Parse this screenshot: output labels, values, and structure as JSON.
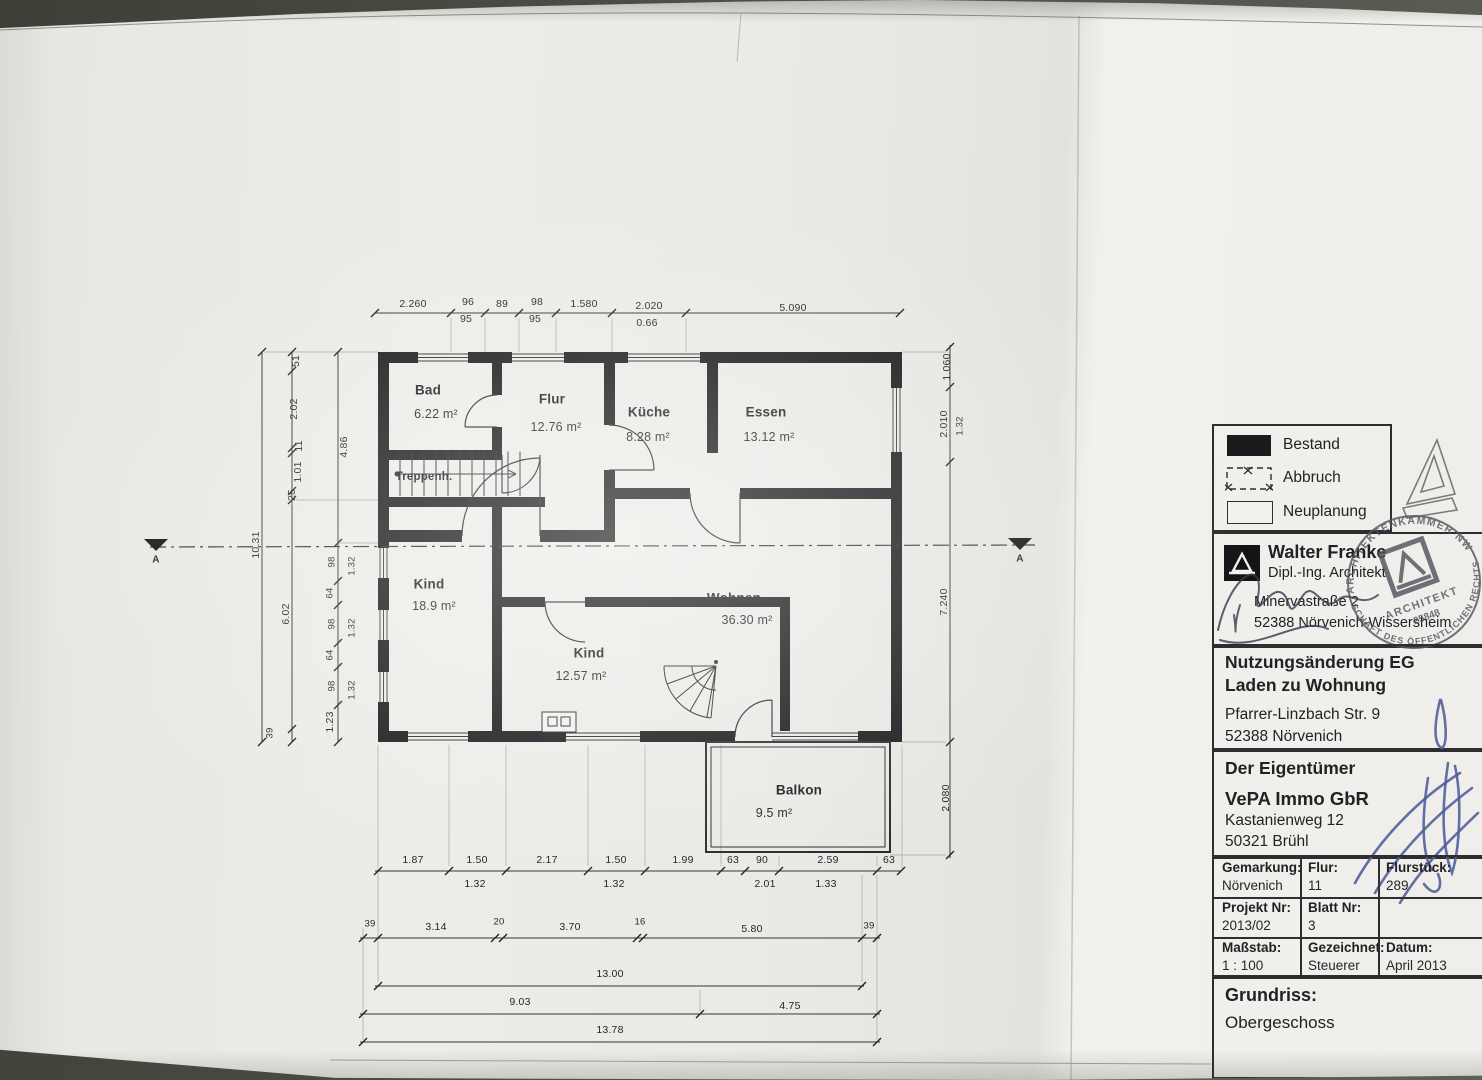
{
  "colors": {
    "background": "#4a4e44",
    "paper": "#edece8",
    "ink": "#222226",
    "wall": "#1b1b1d",
    "signature_blue": "#4d5d9a",
    "stamp_ink": "#54545f"
  },
  "rooms": {
    "bad": {
      "name": "Bad",
      "area": "6.22 m²"
    },
    "flur": {
      "name": "Flur",
      "area": "12.76 m²"
    },
    "kueche": {
      "name": "Küche",
      "area": "8.28 m²"
    },
    "essen": {
      "name": "Essen",
      "area": "13.12 m²"
    },
    "treppenhaus": {
      "name": "Treppenh."
    },
    "kind1": {
      "name": "Kind",
      "area": "18.9 m²"
    },
    "kind2": {
      "name": "Kind",
      "area": "12.57 m²"
    },
    "wohnen": {
      "name": "Wohnen",
      "area": "36.30 m²"
    },
    "balkon": {
      "name": "Balkon",
      "area": "9.5 m²"
    }
  },
  "dims": {
    "top": [
      "2.260",
      "96",
      "95",
      "89",
      "98",
      "95",
      "1.580",
      "2.020",
      "0.66",
      "5.090"
    ],
    "left": [
      "10.31",
      "51",
      "2.02",
      "11",
      "1.01",
      "25",
      "6.02",
      "1.23",
      "39",
      "4.86",
      "98",
      "1.32",
      "64",
      "98",
      "1.32",
      "64",
      "98",
      "1.32"
    ],
    "right": [
      "1.060",
      "2.010",
      "1.32",
      "7.240",
      "2.080"
    ],
    "bottom1": [
      "1.87",
      "1.50",
      "1.32",
      "2.17",
      "1.50",
      "1.32",
      "1.99",
      "63",
      "90",
      "2.01",
      "2.59",
      "1.33",
      "63"
    ],
    "bottom2": [
      "39",
      "3.14",
      "20",
      "3.70",
      "16",
      "5.80",
      "39"
    ],
    "bottom3": [
      "13.00"
    ],
    "bottom4": [
      "9.03",
      "4.75"
    ],
    "bottom5": [
      "13.78"
    ]
  },
  "section": {
    "label": "A"
  },
  "legend": {
    "items": [
      {
        "label": "Bestand"
      },
      {
        "label": "Abbruch"
      },
      {
        "label": "Neuplanung"
      }
    ]
  },
  "architect": {
    "name": "Walter Franke",
    "title": "Dipl.-Ing. Architekt",
    "street": "Minervastraße 2",
    "city": "52388 Nörvenich-Wissersheim"
  },
  "stamp": {
    "ring_top": "ARCHITEKTENKAMMER NW",
    "ring_bottom": "SCHAFT DES ÖFFENTLICHEN RECHTS",
    "center1": "ARCHITEKT",
    "center2": "25848"
  },
  "project": {
    "line1": "Nutzungsänderung EG",
    "line2": "Laden zu Wohnung",
    "street": "Pfarrer-Linzbach Str. 9",
    "city": "52388 Nörvenich"
  },
  "owner": {
    "heading": "Der Eigentümer",
    "name": "VePA Immo GbR",
    "street": "Kastanienweg 12",
    "city": "50321 Brühl"
  },
  "info_table": {
    "rows": [
      [
        {
          "label": "Gemarkung:",
          "value": "Nörvenich"
        },
        {
          "label": "Flur:",
          "value": "11"
        },
        {
          "label": "Flurstück:",
          "value": "289"
        }
      ],
      [
        {
          "label": "Projekt Nr:",
          "value": "2013/02"
        },
        {
          "label": "Blatt Nr:",
          "value": "3"
        },
        {
          "label": "",
          "value": ""
        }
      ],
      [
        {
          "label": "Maßstab:",
          "value": "1 : 100"
        },
        {
          "label": "Gezeichnet:",
          "value": "Steuerer"
        },
        {
          "label": "Datum:",
          "value": "April 2013"
        }
      ]
    ]
  },
  "footer": {
    "label": "Grundriss:",
    "value": "Obergeschoss"
  }
}
